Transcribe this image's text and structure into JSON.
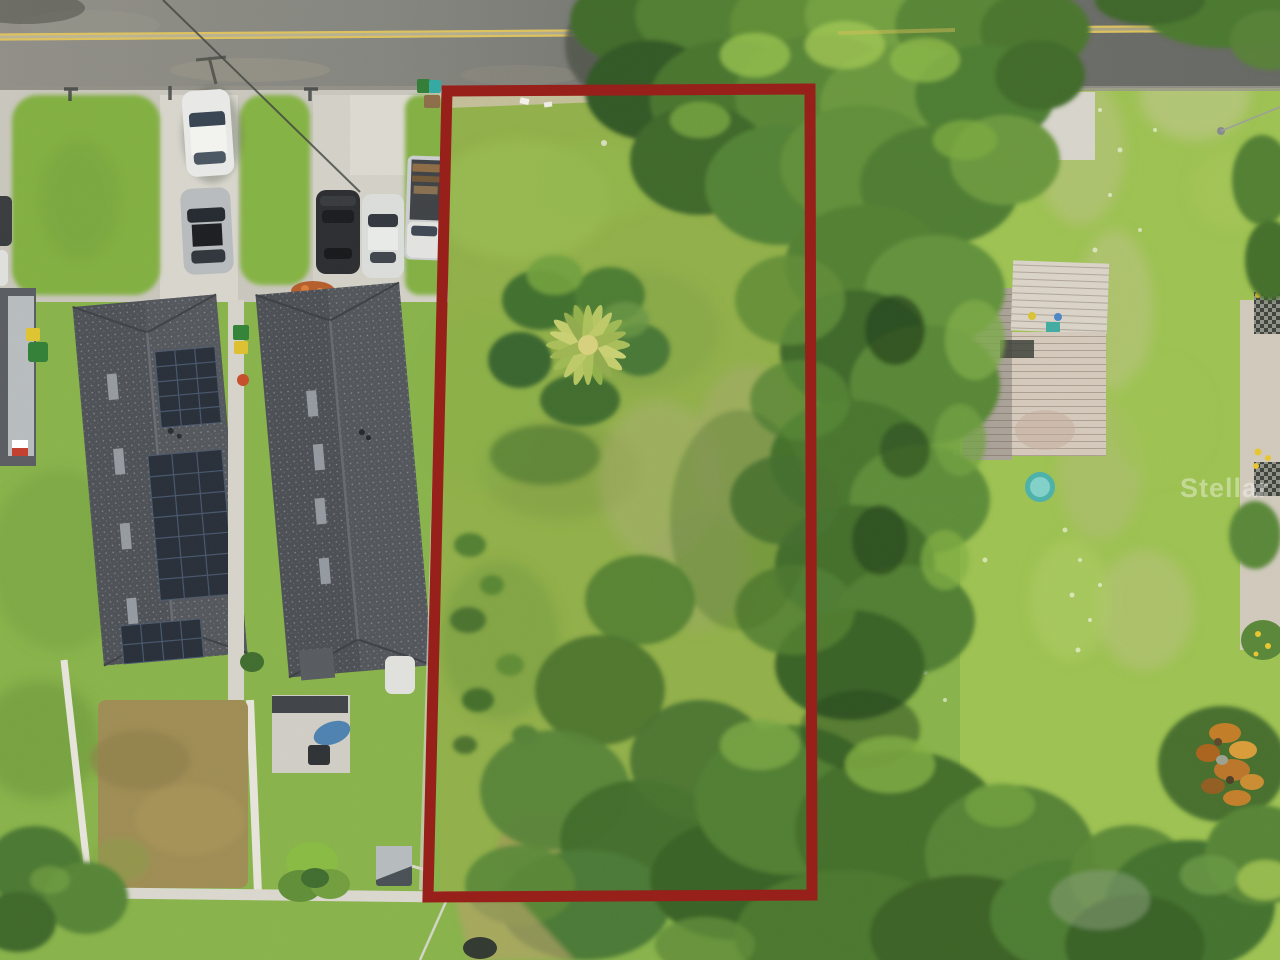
{
  "image": {
    "type": "aerial-drone-photograph",
    "subject": "Overhead drone view of a vacant residential lot outlined with a red property-boundary overlay, beside duplex homes with rooftop solar panels, a street at top, a dense tree row through the middle, and a neighboring yard with a weathered wood deck, kiddie pool and rusty debris pile",
    "watermark": "Stellar MLS"
  },
  "boundary": {
    "color": "#97201a",
    "stroke_width": 11
  },
  "palette": {
    "asphalt_left": "#8e8c85",
    "asphalt_right": "#636560",
    "center_line_yellow": "#dcc05a",
    "grass_base": "#86b147",
    "grass_bright": "#9cc14f",
    "tree_dark": "#3a6326",
    "tree_light": "#7aa93c",
    "concrete": "#ccc9c0",
    "roof_gray": "#4a4e53",
    "solar_panel": "#242b35",
    "deck_wood": "#d3c8ba",
    "pool_teal": "#49b0a8",
    "debris_rust": "#c07a22"
  }
}
